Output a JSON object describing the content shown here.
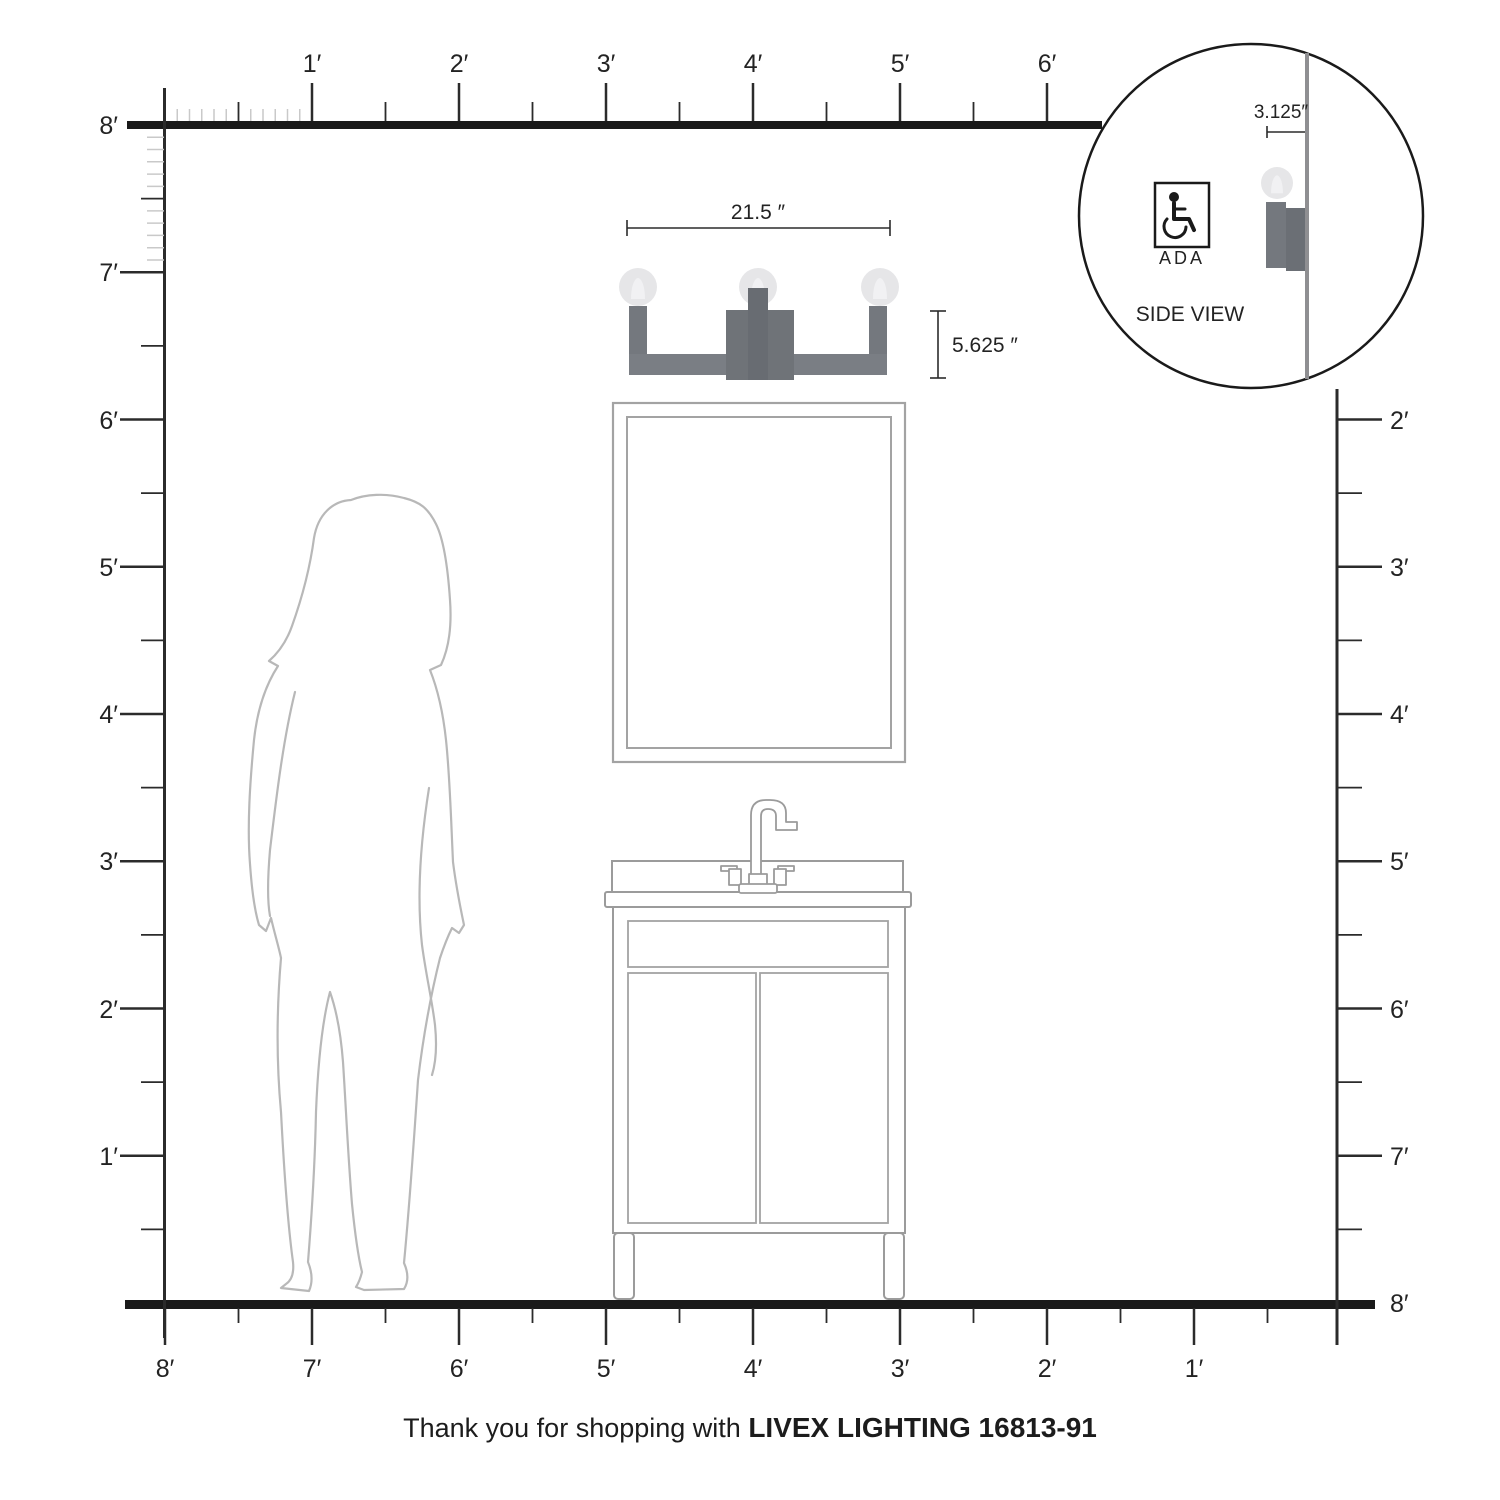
{
  "rulers": {
    "top": {
      "labels": [
        "1′",
        "2′",
        "3′",
        "4′",
        "5′",
        "6′"
      ]
    },
    "left": {
      "labels": [
        "8′",
        "7′",
        "6′",
        "5′",
        "4′",
        "3′",
        "2′",
        "1′"
      ]
    },
    "right": {
      "labels": [
        "2′",
        "3′",
        "4′",
        "5′",
        "6′",
        "7′",
        "8′"
      ]
    },
    "bottom": {
      "labels": [
        "8′",
        "7′",
        "6′",
        "5′",
        "4′",
        "3′",
        "2′",
        "1′"
      ]
    }
  },
  "dimensions": {
    "fixture_width": "21.5 ″",
    "fixture_height": "5.625 ″",
    "fixture_depth": "3.125″"
  },
  "inset": {
    "ada_label": "ADA",
    "title": "SIDE VIEW"
  },
  "footer": {
    "prefix": "Thank you for shopping with ",
    "brand": "LIVEX LIGHTING 16813-91"
  },
  "colors": {
    "line_black": "#1a1a1a",
    "tick_major": "#2b2b2b",
    "tick_minor": "#c9c9c9",
    "outline_gray": "#9b9b9b",
    "mirror_gray": "#a3a3a3",
    "silhouette_gray": "#b8b8b8",
    "fixture_arm": "#74787e",
    "fixture_bar": "#7a7e84",
    "fixture_block": "#6f7378",
    "fixture_stem": "#686c72",
    "inset_plate": "#6b6f75",
    "bulb": "#e6e6e8",
    "bulb_filament": "#f1f1f3",
    "wall_gray": "#8f8f92"
  }
}
